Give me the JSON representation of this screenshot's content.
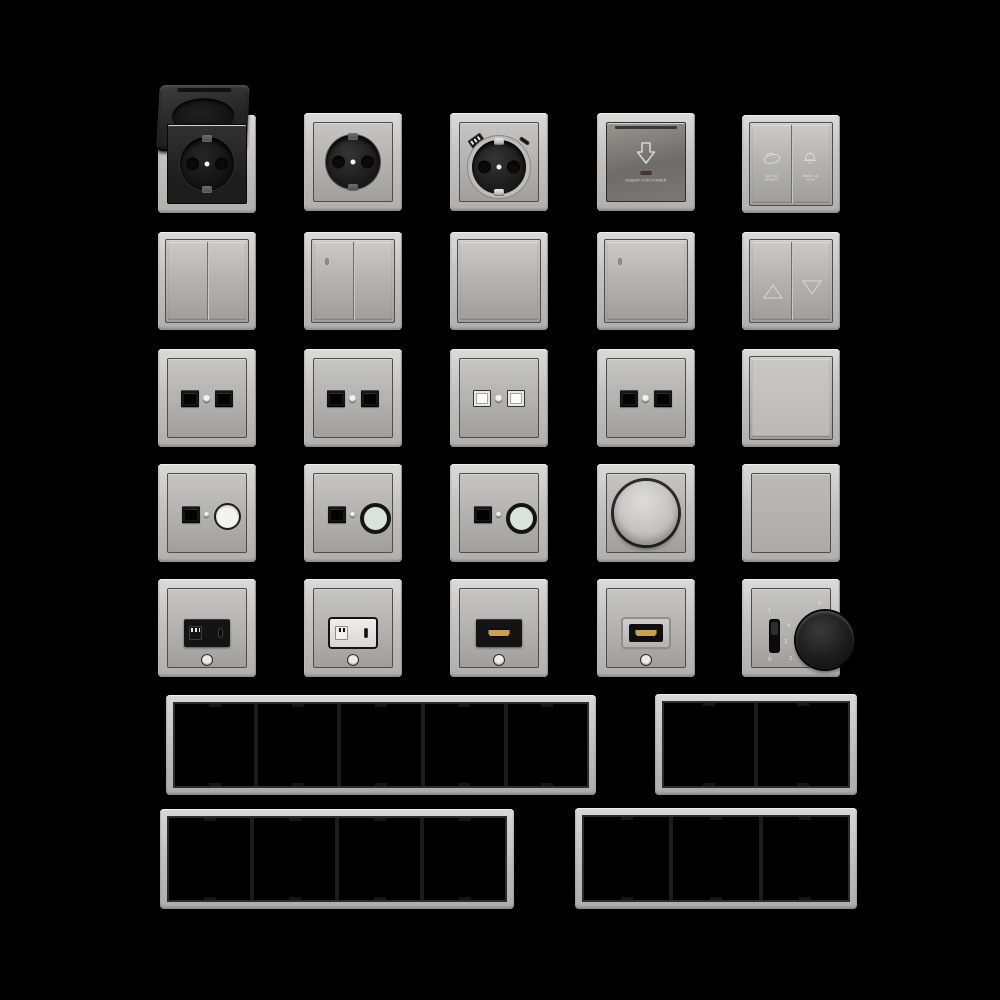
{
  "sheet": {
    "description": "Render sheet of a grey wall switch and socket range with multi-gang frames on black background",
    "palette": {
      "background": "#000000",
      "frame_metal_light": "#c9c8c6",
      "plate_grey": "#b2b1ae",
      "plate_dark_grey": "#6e6c68",
      "device_black": "#1b1b1b",
      "hdmi_gold": "#caa24f",
      "label_light": "#e7e6e2"
    }
  },
  "catalog": [
    {
      "name": "socket-hinged-lid",
      "type": "schuko socket with open flip lid, black insert"
    },
    {
      "name": "socket-schuko",
      "type": "schuko socket, grey"
    },
    {
      "name": "socket-schuko-usb",
      "type": "schuko socket with USB-A and USB-C"
    },
    {
      "name": "keycard-power-switch",
      "type": "hotel key card power holder"
    },
    {
      "name": "hotel-service-switch",
      "type": "2-gang do-not-disturb / make-up-room switch"
    },
    {
      "name": "switch-2gang",
      "type": "double rocker switch"
    },
    {
      "name": "switch-2gang-led",
      "type": "double rocker switch with LED"
    },
    {
      "name": "switch-1gang",
      "type": "single rocker switch"
    },
    {
      "name": "switch-1gang-led",
      "type": "single rocker switch with LED"
    },
    {
      "name": "blind-switch",
      "type": "shutter switch with up/down arrows"
    },
    {
      "name": "data-socket-2port-black-a",
      "type": "twin data socket, black ports"
    },
    {
      "name": "data-socket-2port-black-b",
      "type": "twin data socket, black ports"
    },
    {
      "name": "data-socket-2port-shuttered",
      "type": "twin data socket, light shuttered ports"
    },
    {
      "name": "data-socket-2port-rj45",
      "type": "twin RJ45 network socket"
    },
    {
      "name": "switch-1gang-plain",
      "type": "single rocker switch, flat"
    },
    {
      "name": "media-socket-coax-white",
      "type": "data port with white coax connector"
    },
    {
      "name": "media-socket-coax-dark-a",
      "type": "data port with dark ring coax connector"
    },
    {
      "name": "media-socket-coax-dark-b",
      "type": "data port with dark ring coax connector"
    },
    {
      "name": "rotary-dimmer",
      "type": "rotary dimmer knob"
    },
    {
      "name": "blank-cover",
      "type": "blind cover plate"
    },
    {
      "name": "usb-charger-black",
      "type": "USB-A + USB-C charger, black module"
    },
    {
      "name": "usb-charger-white",
      "type": "USB-A + USB-C charger, light module"
    },
    {
      "name": "hdmi-socket-black",
      "type": "HDMI outlet, black module"
    },
    {
      "name": "hdmi-socket-grey",
      "type": "HDMI outlet, grey module"
    },
    {
      "name": "thermostat-dial",
      "type": "room thermostat with knob and on/off slider"
    },
    {
      "name": "frame-5gang",
      "type": "5-gang frame"
    },
    {
      "name": "frame-2gang",
      "type": "2-gang frame"
    },
    {
      "name": "frame-4gang",
      "type": "4-gang frame"
    },
    {
      "name": "frame-3gang",
      "type": "3-gang frame"
    }
  ],
  "tiles": {
    "keycard": {
      "label": "INSERT FOR POWER",
      "icon": "arrow-down-icon"
    },
    "hotel_switch": {
      "left_label": "Do not disturb",
      "left_icon": "do-not-disturb-icon",
      "right_label": "Make up room",
      "right_icon": "service-bell-icon"
    },
    "blind_switch": {
      "up_icon": "triangle-up-icon",
      "down_icon": "triangle-down-icon"
    },
    "thermostat": {
      "slider_top": "1",
      "slider_bottom": "0",
      "dial_marks": {
        "m6": "6",
        "m4": "4",
        "m3": "3",
        "m2": "2",
        "frost": "❄"
      }
    }
  }
}
